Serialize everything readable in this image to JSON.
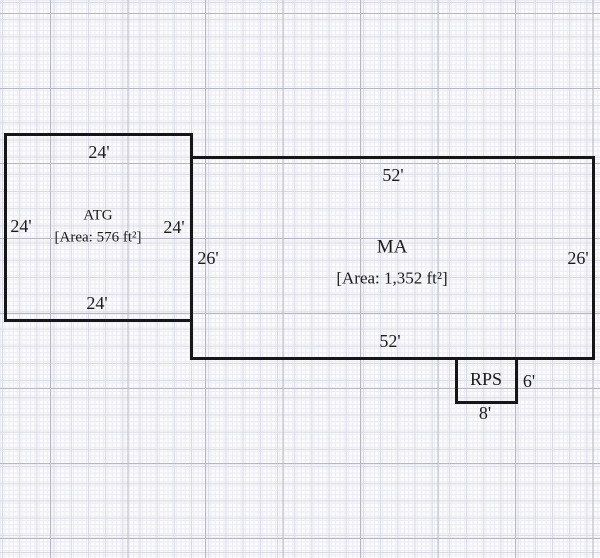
{
  "colors": {
    "paper": "#fbfbfd",
    "grid_minor": "#ebebf2",
    "grid_medium": "#d8d8e2",
    "grid_major": "#b7b7c3",
    "wall": "#161616",
    "text": "#1b1b1b"
  },
  "rooms": [
    {
      "id": "atg",
      "name": "ATG",
      "area_label": "[Area: 576 ft²]",
      "dims": {
        "top": "24'",
        "left": "24'",
        "right": "24'",
        "bottom": "24'"
      }
    },
    {
      "id": "ma",
      "name": "MA",
      "area_label": "[Area: 1,352 ft²]",
      "dims": {
        "top": "52'",
        "left": "26'",
        "right": "26'",
        "bottom": "52'"
      }
    },
    {
      "id": "rps",
      "name": "RPS",
      "dims": {
        "right": "6'",
        "bottom": "8'"
      }
    }
  ]
}
